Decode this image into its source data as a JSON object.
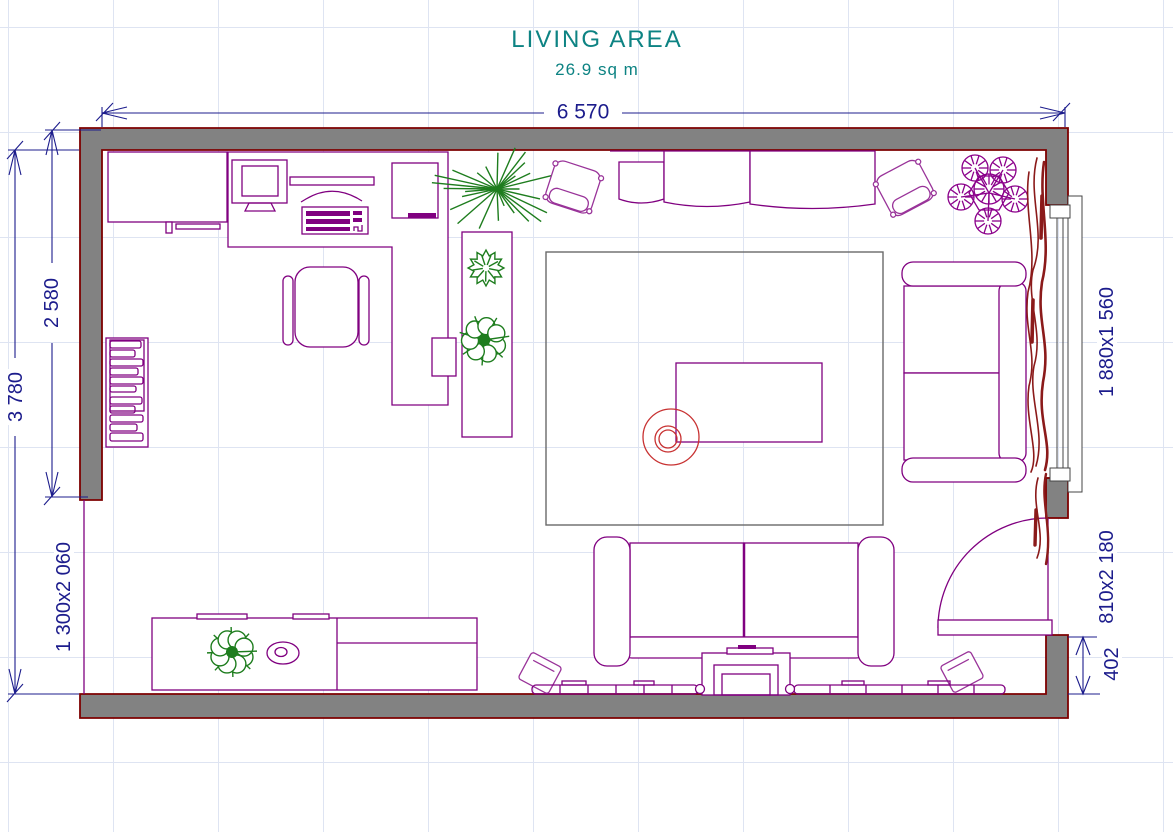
{
  "title": {
    "name": "LIVING AREA",
    "area": "26.9 sq m"
  },
  "dimensions": {
    "top_width": "6 570",
    "left_inner_height": "2 580",
    "left_total_height": "3 780",
    "left_opening": "1 300x2 060",
    "right_window": "1 880x1 560",
    "right_door": "810x2 180",
    "right_wall_segment": "402"
  },
  "palette": {
    "wall_fill": "#828282",
    "wall_outline": "#7d0000",
    "furniture": "#800080",
    "furniture_alt": "#993399",
    "plant_green": "#1e7d1e",
    "plant_purple": "#8b008b",
    "curtain": "#8b1a1a",
    "accent_red": "#c83232",
    "dimension": "#1c1c8c",
    "title": "#0d8383",
    "grid": "#dee4f2",
    "rug": "#6a6a6a",
    "background": "#ffffff"
  }
}
